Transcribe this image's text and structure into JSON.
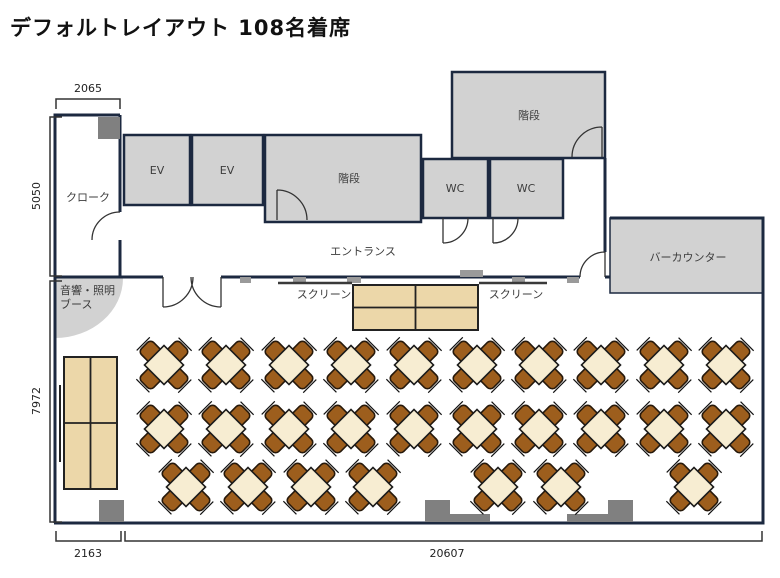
{
  "title": "デフォルトレイアウト 108名着席",
  "rooms": {
    "cloak": {
      "label": "クローク"
    },
    "ev1": {
      "label": "EV"
    },
    "ev2": {
      "label": "EV"
    },
    "stairs_main": {
      "label": "階段"
    },
    "stairs_upper": {
      "label": "階段"
    },
    "wc1": {
      "label": "WC"
    },
    "wc2": {
      "label": "WC"
    },
    "entrance": {
      "label": "エントランス"
    },
    "bar_counter": {
      "label": "バーカウンター"
    },
    "booth": {
      "label_line1": "音響・照明",
      "label_line2": "ブース"
    }
  },
  "screens": {
    "left_label": "スクリーン",
    "right_label": "スクリーン"
  },
  "dimensions": {
    "cloak_width": "2065",
    "upper_height": "5050",
    "hall_height": "7972",
    "bottom_left_width": "2163",
    "hall_width": "20607"
  },
  "colors": {
    "wall": "#1c2940",
    "room_fill": "#d2d2d2",
    "pillar": "#808080",
    "fixture": "#9a9a9a",
    "table_cream": "#f7edd2",
    "long_table_cream": "#ecd7a9",
    "chair_brown": "#9d5e1d",
    "chair_border": "#27190b"
  },
  "seating": {
    "seats_per_table": 4,
    "table_count": 27,
    "table_groups": [
      {
        "x": 164,
        "y": 365
      },
      {
        "x": 226,
        "y": 365
      },
      {
        "x": 289,
        "y": 365
      },
      {
        "x": 351,
        "y": 365
      },
      {
        "x": 414,
        "y": 365
      },
      {
        "x": 477,
        "y": 365
      },
      {
        "x": 539,
        "y": 365
      },
      {
        "x": 601,
        "y": 365
      },
      {
        "x": 664,
        "y": 365
      },
      {
        "x": 726,
        "y": 365
      },
      {
        "x": 164,
        "y": 429
      },
      {
        "x": 226,
        "y": 429
      },
      {
        "x": 289,
        "y": 429
      },
      {
        "x": 351,
        "y": 429
      },
      {
        "x": 414,
        "y": 429
      },
      {
        "x": 477,
        "y": 429
      },
      {
        "x": 539,
        "y": 429
      },
      {
        "x": 601,
        "y": 429
      },
      {
        "x": 664,
        "y": 429
      },
      {
        "x": 726,
        "y": 429
      },
      {
        "x": 186,
        "y": 487
      },
      {
        "x": 248,
        "y": 487
      },
      {
        "x": 311,
        "y": 487
      },
      {
        "x": 373,
        "y": 487
      },
      {
        "x": 498,
        "y": 487
      },
      {
        "x": 561,
        "y": 487
      },
      {
        "x": 694,
        "y": 487
      }
    ]
  }
}
